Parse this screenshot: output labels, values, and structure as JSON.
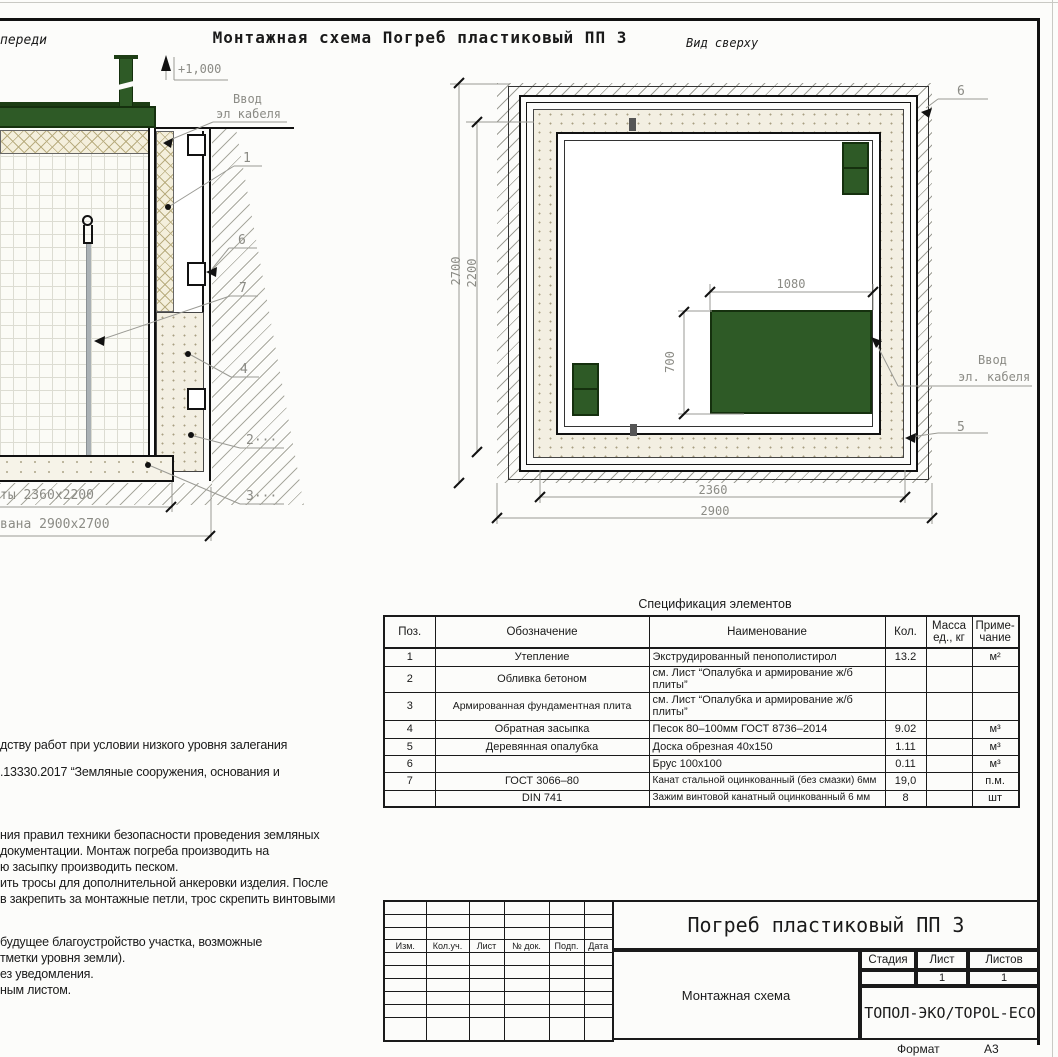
{
  "colors": {
    "cellar_green": "#2e5a26",
    "green_border": "#15300e",
    "line": "#1a1a1a",
    "dim_gray": "#8b8b85"
  },
  "header": {
    "left_view_label": "переди",
    "title": "Монтажная схема Погреб пластиковый ПП 3",
    "right_view_label": "Вид сверху"
  },
  "front_view": {
    "elevation_mark": "+1,000",
    "cable_entry_line1": "Ввод",
    "cable_entry_line2": "эл кабеля",
    "callouts": [
      "1",
      "6",
      "7",
      "4",
      "2···",
      "3···"
    ],
    "dim_plate": "ты 2360х2200",
    "dim_pit": "вана 2900х2700"
  },
  "top_view": {
    "cable_entry_line1": "Ввод",
    "cable_entry_line2": "эл. кабеля",
    "callout_top": "6",
    "callout_bottom": "5",
    "dims": {
      "outer_height": "2700",
      "inner_height": "2200",
      "lid_width": "1080",
      "lid_height": "700",
      "inner_width": "2360",
      "outer_width": "2900"
    }
  },
  "spec": {
    "title": "Спецификация элементов",
    "headers": {
      "pos": "Поз.",
      "mark": "Обозначение",
      "name": "Наименование",
      "qty": "Кол.",
      "mass1": "Масса",
      "mass2": "ед., кг",
      "note1": "Приме-",
      "note2": "чание"
    },
    "rows": [
      {
        "pos": "1",
        "mark": "Утепление",
        "name": "Экструдированный пенополистирол",
        "qty": "13.2",
        "mass": "",
        "note": "м²"
      },
      {
        "pos": "2",
        "mark": "Обливка бетоном",
        "name": "см. Лист “Опалубка и армирование ж/б плиты”",
        "qty": "",
        "mass": "",
        "note": ""
      },
      {
        "pos": "3",
        "mark": "Армированная фундаментная плита",
        "name": "см. Лист “Опалубка и армирование ж/б плиты”",
        "qty": "",
        "mass": "",
        "note": ""
      },
      {
        "pos": "4",
        "mark": "Обратная засыпка",
        "name": "Песок 80–100мм ГОСТ 8736–2014",
        "qty": "9.02",
        "mass": "",
        "note": "м³"
      },
      {
        "pos": "5",
        "mark": "Деревянная опалубка",
        "name": "Доска обрезная 40х150",
        "qty": "1.11",
        "mass": "",
        "note": "м³"
      },
      {
        "pos": "6",
        "mark": "",
        "name": "Брус 100х100",
        "qty": "0.11",
        "mass": "",
        "note": "м³"
      },
      {
        "pos": "7",
        "mark": "ГОСТ 3066–80",
        "name": "Канат стальной оцинкованный (без смазки) 6мм",
        "qty": "19,0",
        "mass": "",
        "note": "п.м."
      },
      {
        "pos": "",
        "mark": "DIN 741",
        "name": "Зажим винтовой канатный оцинкованный 6 мм",
        "qty": "8",
        "mass": "",
        "note": "шт"
      }
    ]
  },
  "notes": {
    "lines": [
      {
        "text": "дству работ при условии низкого уровня залегания"
      },
      {
        "text": ".13330.2017 “Земляные сооружения, основания и"
      },
      {
        "text": "ния правил техники безопасности проведения земляных"
      },
      {
        "text": "документации. Монтаж погреба производить на"
      },
      {
        "text": "ю засыпку производить песком."
      },
      {
        "text": "ить тросы для дополнительной анкеровки изделия. После"
      },
      {
        "text": "в закрепить за монтажные петли, трос скрепить винтовыми"
      },
      {
        "text": "будущее благоустройство участка, возможные"
      },
      {
        "text": "тметки уровня земли)."
      },
      {
        "text": "ез уведомления."
      },
      {
        "text": "ным листом."
      }
    ]
  },
  "title_block": {
    "project_title": "Погреб пластиковый ПП 3",
    "doc_type": "Монтажная схема",
    "company": "ТОПОЛ-ЭКО/TOPOL-ECO",
    "columns": [
      "Изм.",
      "Кол.уч.",
      "Лист",
      "№ док.",
      "Подп.",
      "Дата"
    ],
    "stage_label": "Стадия",
    "sheet_label": "Лист",
    "sheets_label": "Листов",
    "stage_value": "",
    "sheet_value": "1",
    "sheets_value": "1",
    "format_label": "Формат",
    "format_value": "А3"
  }
}
